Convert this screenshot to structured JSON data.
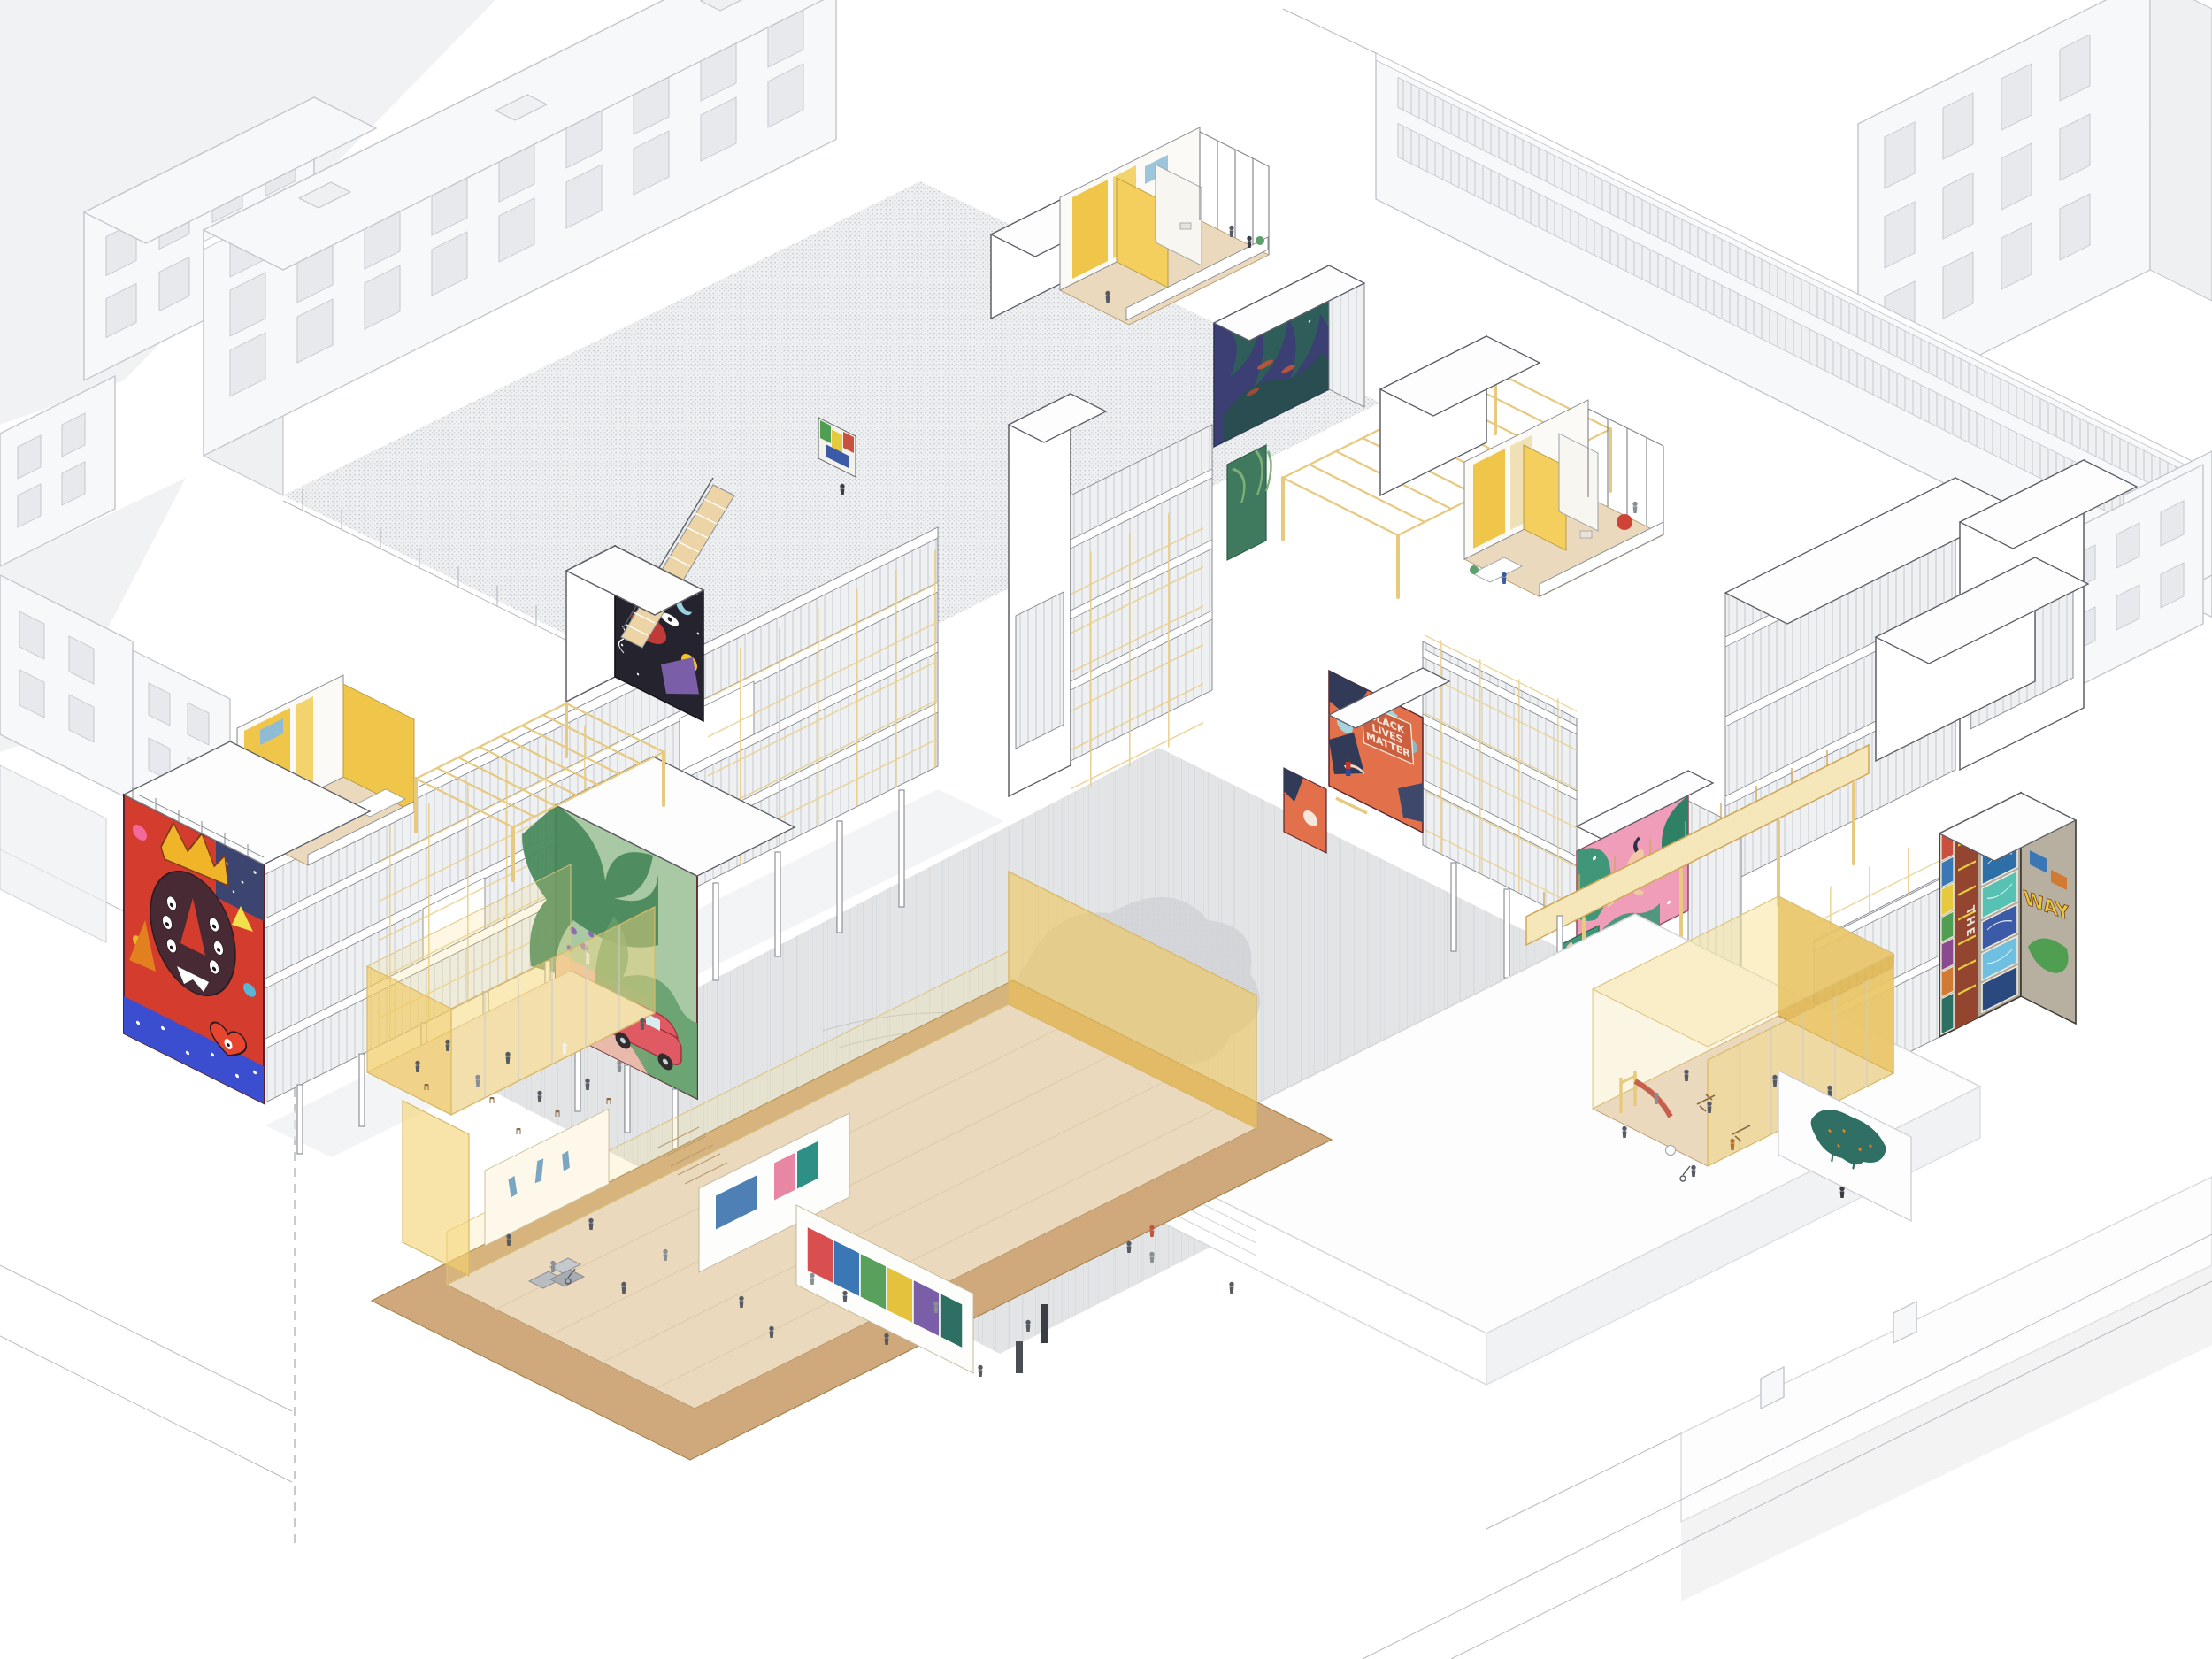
{
  "artwork": {
    "kind": "axonometric-cutaway-architectural-illustration",
    "subject": "timber-frame co-housing block with street-art murals, courtyard, playground, community hall and underground gallery"
  },
  "palette": {
    "paper": "#ffffff",
    "context_line": "#c2c6cb",
    "main_line": "#5c6066",
    "glazing": "#eef0f2",
    "timber": "#e7c97f",
    "timber_light": "#f6e7bb",
    "gold_wall": "#e0b44c",
    "glass_yellow": "#f5d98c",
    "wood_floor": "#ead9bd",
    "earth": "#cfa97c",
    "paving": "#e2e4e6",
    "plaza": "#fdfdfe",
    "tree": "#d3d5d8",
    "shadow": "#ebedee",
    "figure": "#565b63"
  },
  "murals": {
    "king": {
      "label": "crowned-face mural",
      "bg": "#d43d2e",
      "crown": "#f0b429",
      "face": "#472a33",
      "band": "#3c4ed0",
      "accent": "#f4699b"
    },
    "jungle": {
      "label": "jungle-and-car mural",
      "bg": "#a9c9a4",
      "leaf": "#4a8a5d",
      "path": "#e9b9ac",
      "car": "#e05a63"
    },
    "cosmos": {
      "label": "cosmic night mural with stair",
      "bg": "#25242e",
      "sun": "#f2c230",
      "red": "#c03a37",
      "purple": "#7b5ea8"
    },
    "night": {
      "label": "night-jungle mural",
      "bg": "#3b3f74",
      "leaf": "#2e6158",
      "fish": "#b5543e"
    },
    "palms": {
      "label": "palm mural",
      "bg": "#3f7a5e",
      "leaf": "#7fae79"
    },
    "blm": {
      "label": "Black Lives Matter mural",
      "bg": "#e2714b",
      "navy": "#313b58",
      "sky": "#a6d3de",
      "sign": "#cc5f3d",
      "words": [
        "BLACK",
        "LIVES",
        "MATTER"
      ]
    },
    "swimmer": {
      "label": "diver mural",
      "bg": "#ef9db8",
      "leaf": "#3f9678",
      "skin": "#f2c9a8",
      "suit": "#2c2f45"
    },
    "rays": {
      "label": "ray-burst mural",
      "bg": "#f0b7c9",
      "ray": "#d96c8e"
    },
    "graffiti": {
      "label": "graffiti collage mural",
      "base": "#b3a99b",
      "frame": "#94452f",
      "panel": "#4fb3d4",
      "accent": "#e5c93f",
      "green": "#4f9e52",
      "word_band": "THE",
      "word_side": "WAY"
    },
    "paste_up": {
      "label": "teal paste-up on street wall",
      "color": "#2f6f64"
    },
    "roof_small": {
      "label": "small rooftop mural",
      "a": "#4f9e52",
      "b": "#e5c93f",
      "c": "#c9503e"
    }
  }
}
